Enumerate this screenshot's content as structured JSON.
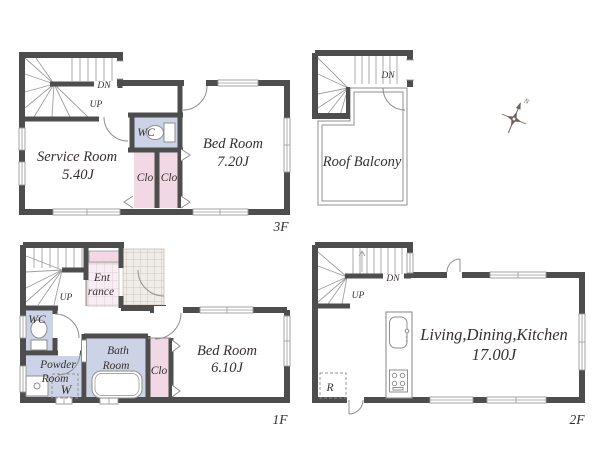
{
  "colors": {
    "wall": "#4d4d4d",
    "lavender": "#ccd3e6",
    "pink": "#f1d8e4",
    "tile-bg": "#f7eef3",
    "tile-line": "#ddc7d4",
    "porch-bg": "#f0ece8",
    "porch-line": "#c6bcb4",
    "line": "#8f8f8f",
    "tread": "#a0a0a0",
    "win": "#9a9a9a",
    "text": "#35302e",
    "compass": "#6e625c"
  },
  "floors": {
    "f3": {
      "floor_label": "3F",
      "service_name": "Service Room",
      "service_size": "5.40J",
      "bed_name": "Bed Room",
      "bed_size": "7.20J",
      "wc": "WC",
      "clo_left": "Clo",
      "clo_right": "Clo",
      "dn": "DN",
      "up": "UP"
    },
    "roof": {
      "name": "Roof Balcony",
      "dn": "DN"
    },
    "f1": {
      "floor_label": "1F",
      "entrance_line1": "Ent",
      "entrance_line2": "rance",
      "wc": "WC",
      "powder_line1": "Powder",
      "powder_line2": "Room",
      "washer": "W",
      "bath_line1": "Bath",
      "bath_line2": "Room",
      "clo": "Clo",
      "bed_name": "Bed Room",
      "bed_size": "6.10J",
      "up": "UP"
    },
    "f2": {
      "floor_label": "2F",
      "ldk_name": "Living,Dining,Kitchen",
      "ldk_size": "17.00J",
      "fridge": "R",
      "dn": "DN",
      "up": "UP"
    }
  },
  "compass": {
    "north": "N"
  }
}
